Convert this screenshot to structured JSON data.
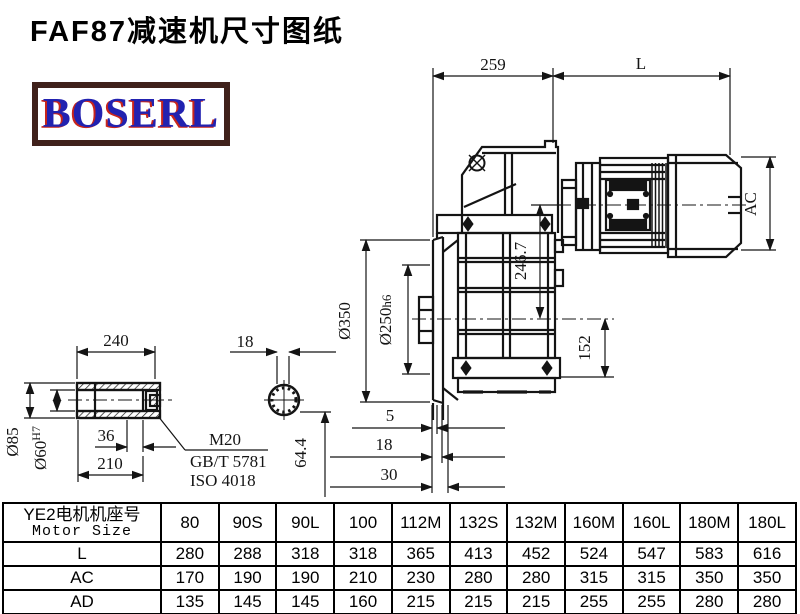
{
  "title": "FAF87减速机尺寸图纸",
  "logo": {
    "text": "BOSERL",
    "border_color": "#40211b",
    "text_color": "#2222b0",
    "shadow_color": "#c8251c"
  },
  "drawing": {
    "dims": {
      "d259": "259",
      "L": "L",
      "AC": "AC",
      "d246_7": "246.7",
      "d350": "Ø350",
      "d250": "Ø250",
      "d250_tol": "h6",
      "d152": "152",
      "d240": "240",
      "d18_top": "18",
      "d85": "Ø85",
      "d60": "Ø60",
      "d60_tol": "H7",
      "d36": "36",
      "d210": "210",
      "m20": "M20",
      "gbt": "GB/T 5781",
      "iso": "ISO 4018",
      "d64_4": "64.4",
      "d5": "5",
      "d18": "18",
      "d30": "30"
    }
  },
  "table": {
    "header": {
      "line1": "YE2电机机座号",
      "line2": "Motor Size"
    },
    "columns": [
      "80",
      "90S",
      "90L",
      "100",
      "112M",
      "132S",
      "132M",
      "160M",
      "160L",
      "180M",
      "180L"
    ],
    "rows": [
      {
        "label": "L",
        "values": [
          "280",
          "288",
          "318",
          "318",
          "365",
          "413",
          "452",
          "524",
          "547",
          "583",
          "616"
        ]
      },
      {
        "label": "AC",
        "values": [
          "170",
          "190",
          "190",
          "210",
          "230",
          "280",
          "280",
          "315",
          "315",
          "350",
          "350"
        ]
      },
      {
        "label": "AD",
        "values": [
          "135",
          "145",
          "145",
          "160",
          "215",
          "215",
          "215",
          "255",
          "255",
          "280",
          "280"
        ]
      }
    ]
  }
}
